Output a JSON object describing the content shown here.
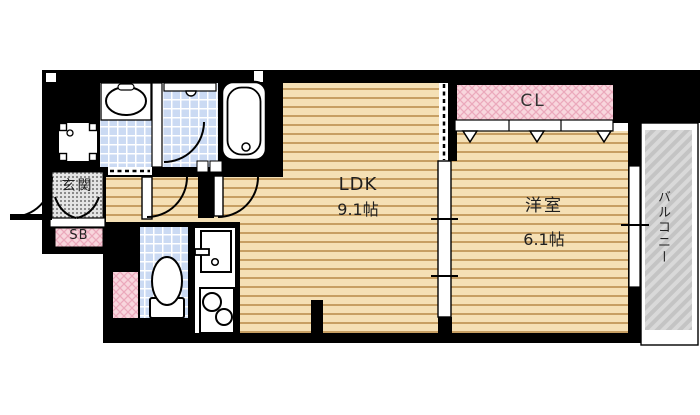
{
  "plan_title": "1LDK apartment floor plan",
  "rooms": {
    "ldk": {
      "label": "LDK",
      "size": "9.1帖"
    },
    "western": {
      "label": "洋室",
      "size": "6.1帖"
    },
    "closet": {
      "label": "CL"
    },
    "entrance": {
      "label": "玄関"
    },
    "shoe_box": {
      "label": "SB"
    },
    "balcony": {
      "label": "バルコニー"
    }
  },
  "colors": {
    "bg": "#ffffff",
    "wall": "#000000",
    "floor": "#f5e0b5",
    "floor_line": "#c79f63",
    "tile": "#cbdaf3",
    "tile_line": "#ffffff",
    "pink": "#f8d6dd",
    "pink_line": "#eba9bc",
    "balcony": "#d9d9d9",
    "balcony_line": "#c4c4c4",
    "genkan": "#e4e4e4",
    "genkan_dot": "#8a8a8a",
    "text": "#1f1f1f"
  }
}
